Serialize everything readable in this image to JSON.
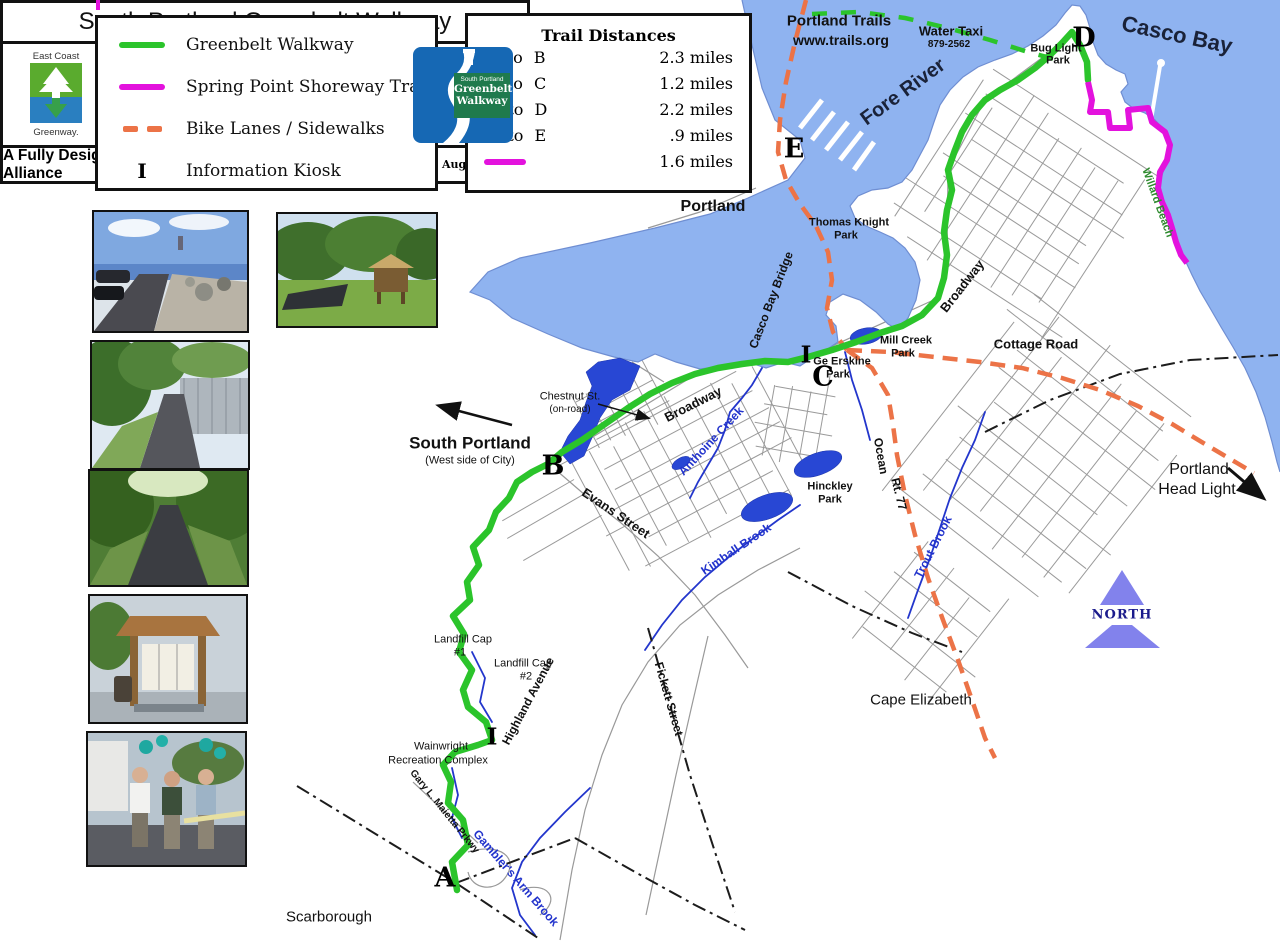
{
  "colors": {
    "water": "#8fb3f0",
    "coast": "#6f8ed2",
    "pond": "#2847d4",
    "stream": "#2336cc",
    "stream-label": "#2233cc",
    "greenbelt": "#2bc42b",
    "shoreway": "#e312dd",
    "bike": "#ec7347",
    "road": "#999999",
    "north-fill": "#8282ec",
    "willard-label": "#2d8a2d"
  },
  "legend": {
    "items": [
      {
        "label": "Greenbelt Walkway",
        "swatch": "green-line"
      },
      {
        "label": "Spring Point Shoreway Trail",
        "swatch": "magenta-line"
      },
      {
        "label": "Bike Lanes / Sidewalks",
        "swatch": "orange-dashes"
      },
      {
        "label": "Information Kiosk",
        "swatch": "letter",
        "symbol": "I"
      }
    ]
  },
  "distances": {
    "title": "Trail Distances",
    "rows": [
      {
        "label": "A to B",
        "value": "2.3 miles"
      },
      {
        "label": "B to C",
        "value": "1.2 miles"
      },
      {
        "label": "C to D",
        "value": "2.2 miles"
      },
      {
        "label": "C to E",
        "value": ".9 miles"
      },
      {
        "label": "",
        "value": "1.6 miles"
      }
    ]
  },
  "map": {
    "labels": {
      "portland_trails": "Portland Trails",
      "trails_url": "www.trails.org",
      "water_taxi": "Water Taxi",
      "water_taxi_phone": "879-2562",
      "casco_bay": "Casco Bay",
      "fore_river": "Fore River",
      "portland": "Portland",
      "south_portland": "South Portland",
      "west_side": "(West side of City)",
      "scarborough": "Scarborough",
      "cape_elizabeth": "Cape Elizabeth",
      "portland_head_1": "Portland",
      "portland_head_2": "Head Light",
      "north": "NORTH",
      "bug_light_1": "Bug Light",
      "bug_light_2": "Park",
      "thomas_knight_1": "Thomas Knight",
      "thomas_knight_2": "Park",
      "mill_creek_1": "Mill Creek",
      "mill_creek_2": "Park",
      "ge_erskine_1": "Ge Erskine",
      "ge_erskine_2": "Park",
      "hinckley_1": "Hinckley",
      "hinckley_2": "Park",
      "willard_beach": "Willard Beach",
      "broadway": "Broadway",
      "evans_street": "Evans Street",
      "highland_avenue": "Highland Avenue",
      "fickett_street": "Fickett Street",
      "cottage_road": "Cottage Road",
      "ocean": "Ocean",
      "rt_77": "Rt. 77",
      "casco_bay_bridge": "Casco Bay Bridge",
      "chestnut_1": "Chestnut St.",
      "chestnut_2": "(on-road)",
      "maietta_pkwy": "Gary L. Maietta Prkwy",
      "anthoine_creek": "Anthoine Creek",
      "kimball_brook": "Kimball Brook",
      "trout_brook": "Trout Brook",
      "gamblers_brook": "Gambler's Arm Brook",
      "landfill_cap": "Landfill Cap",
      "landfill_1": "#1",
      "landfill_2": "#2",
      "wainwright_1": "Wainwright",
      "wainwright_2": "Recreation Complex"
    },
    "markers": {
      "a": "A",
      "b": "B",
      "c": "C",
      "d": "D",
      "e": "E",
      "i": "I"
    }
  },
  "title_block": {
    "title": "South Portland Greenbelt Walkway",
    "footer": "A Fully Designated Trail by the East Coast Greenway Alliance",
    "date": "August 2004",
    "ecg_top": "East Coast",
    "ecg_bottom": "Greenway.",
    "city_1": "City of",
    "city_2": "South",
    "city_3": "Portland",
    "gw_1": "South Portland",
    "gw_2": "Greenbelt",
    "gw_3": "Walkway"
  }
}
